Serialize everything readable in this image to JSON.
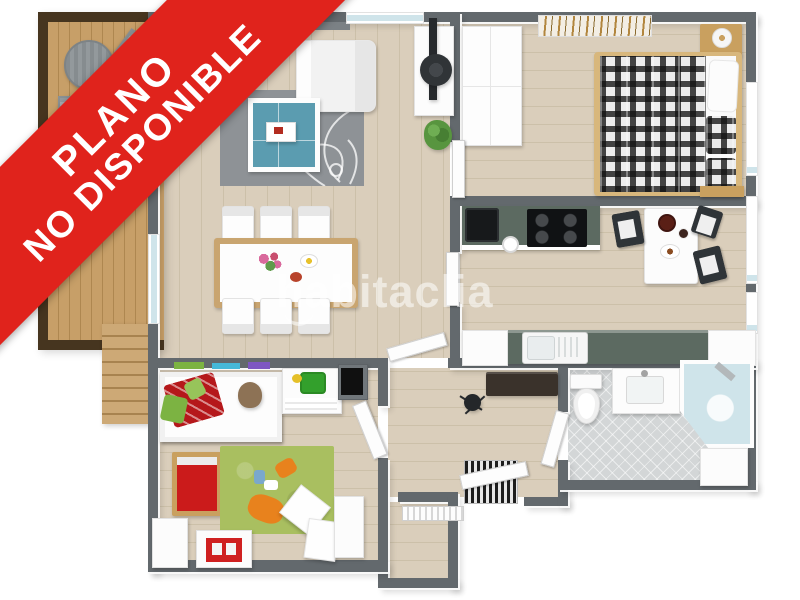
{
  "banner": {
    "line1": "PLANO",
    "line2": "NO DISPONIBLE"
  },
  "watermark": {
    "text": "habitaclia"
  },
  "palette": {
    "banner-red": "#e0231c",
    "wall": "#63696d",
    "wall-light": "#7b8185",
    "floor-wood": "#dacebb",
    "floor-line": "#ccc0a9",
    "terrace-wood": "#c79f68",
    "terrace-line": "#ae8750",
    "terrace-frame": "#46351f",
    "stair-wood": "#cda976",
    "bath-tile": "#d3d6d7",
    "rug-gray": "#8e9296",
    "rug-green": "#a9bf60",
    "coffee-table-blue": "#5b9cb0",
    "counter-top": "#5c6a61",
    "appliance-black": "#17191b",
    "dark-wood": "#3a322b",
    "bed-wood": "#d8b77c",
    "furniture-wood": "#c9a05f",
    "red-accent": "#cb1b1b",
    "glass-blue": "#cfe4ea",
    "watermark-white": "rgba(255,255,255,0.55)"
  },
  "regions": [
    "terrace",
    "staircase",
    "living-room",
    "dining-area",
    "study-nook",
    "bedroom",
    "kitchen",
    "hallway",
    "kids-room",
    "bathroom",
    "storage-room"
  ]
}
